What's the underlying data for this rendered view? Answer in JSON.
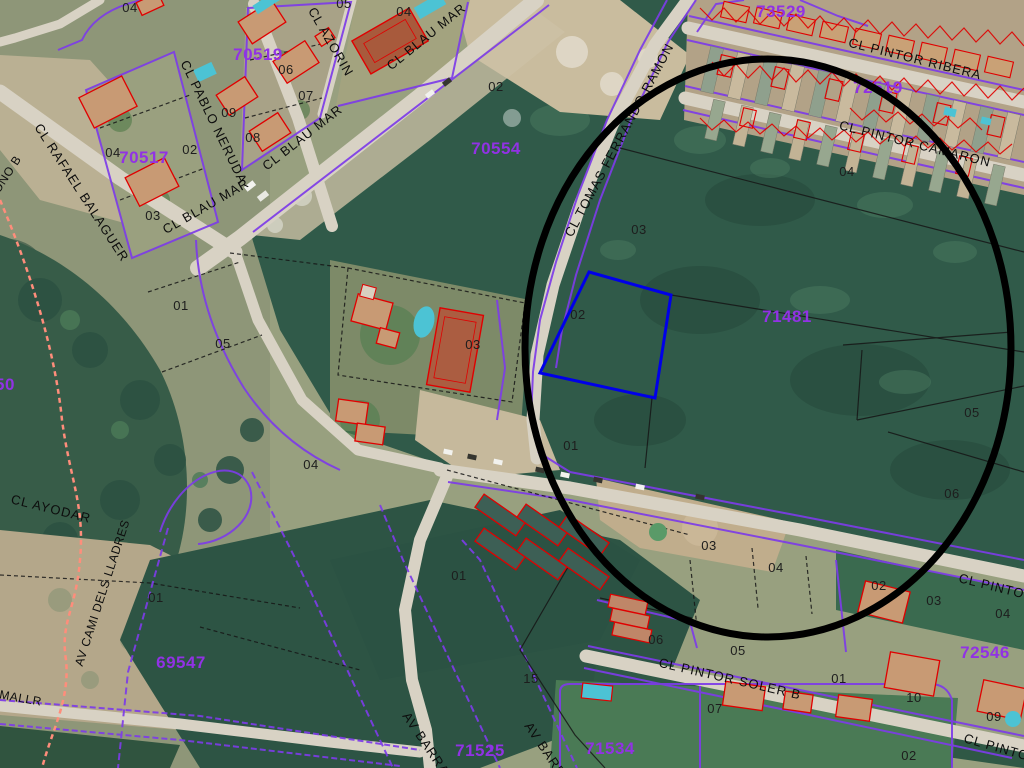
{
  "map_type": "cadastral-aerial",
  "streets": [
    "CL BLAU MAR",
    "CL BLAU MAR",
    "CL BLAU MAR",
    "CL PABLO NERUDA",
    "CL AZORIN",
    "CL RAFAEL BALAGUER",
    "CL TOMAS FERRANDO RAMON",
    "CL PINTOR RIBERA",
    "CL PINTOR CAMARON",
    "CL PINTOR",
    "CL PINTOR SOLER B",
    "CL PINTOR",
    "CL AYODAR",
    "AV CAMI DELS LLADRES",
    "AV BARRANQ",
    "AV BARRANQ",
    "BONO B",
    "MALLR"
  ],
  "parcels": [
    "70519",
    "70517",
    "70554",
    "73529",
    "72519",
    "71481",
    "69547",
    "71525",
    "71534",
    "72546",
    "50"
  ],
  "plots": [
    "04",
    "05",
    "04",
    "06",
    "07",
    "09",
    "08",
    "02",
    "04",
    "03",
    "02",
    "01",
    "05",
    "03",
    "04",
    "02",
    "03",
    "04",
    "01",
    "05",
    "06",
    "01",
    "15",
    "01",
    "03",
    "04",
    "02",
    "03",
    "04",
    "06",
    "05",
    "07",
    "01",
    "10",
    "09",
    "02"
  ],
  "annotations": {
    "ellipse_note": "hand-drawn black ellipse highlighting area",
    "highlight_note": "selected parcel outlined in blue"
  },
  "colors": {
    "cadastral_line": "#7d3ce8",
    "parcel_label": "#9132e4",
    "plot_number": "#1d1d1d",
    "street_label": "#0d0d0d",
    "building_outline": "#e00000",
    "highlight_parcel": "#0000e8",
    "annotation": "#000000",
    "boundary_dashed": "#ff8d7b",
    "pool": "#4cc3d4"
  }
}
